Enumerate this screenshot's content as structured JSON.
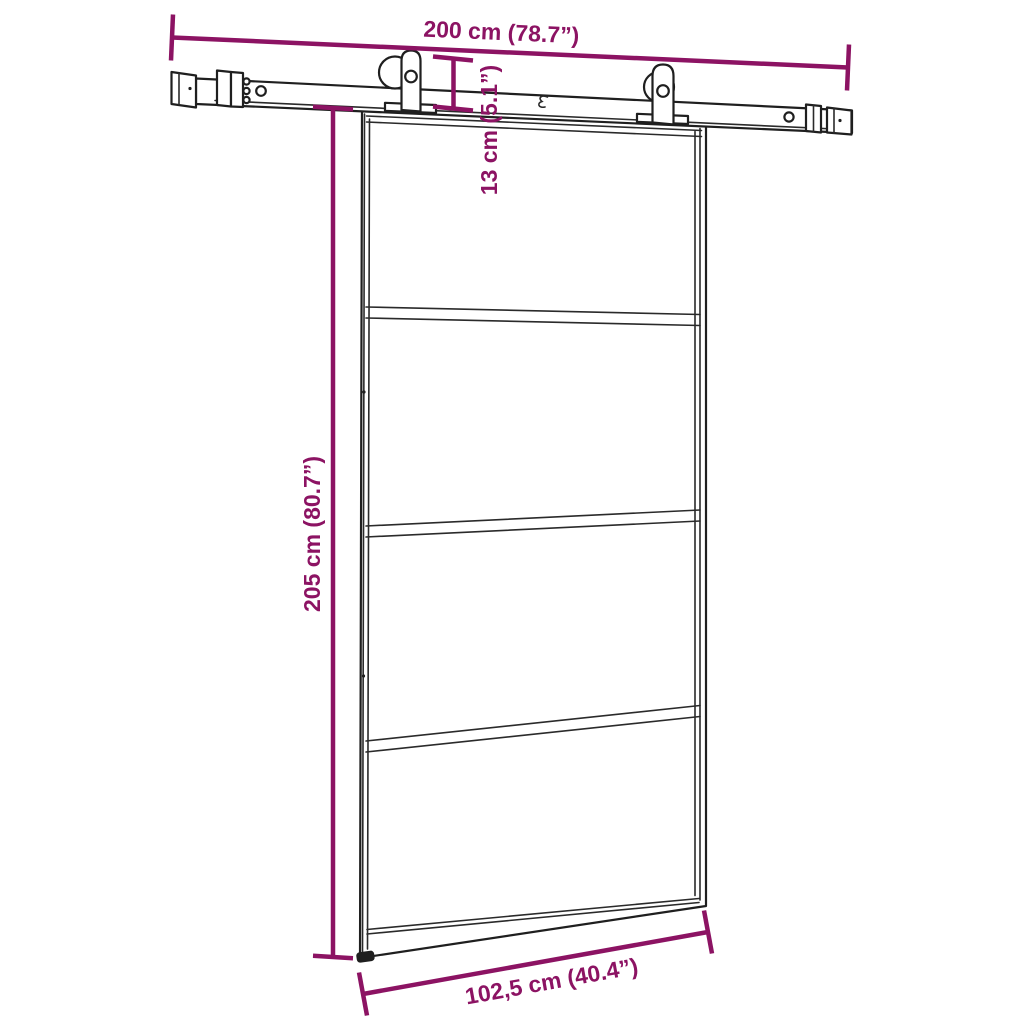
{
  "canvas": {
    "background": "#ffffff",
    "line_color": "#1f1f1f",
    "dimension_color": "#8C1363"
  },
  "labels": {
    "track_width": "200 cm (78.7”)",
    "hardware_height": "13 cm (5.1”)",
    "door_height": "205 cm (80.7”)",
    "door_width": "102,5 cm (40.4”)"
  },
  "structure": {
    "glass_panels": 4,
    "divider_bars": 3,
    "rollers": 2
  }
}
